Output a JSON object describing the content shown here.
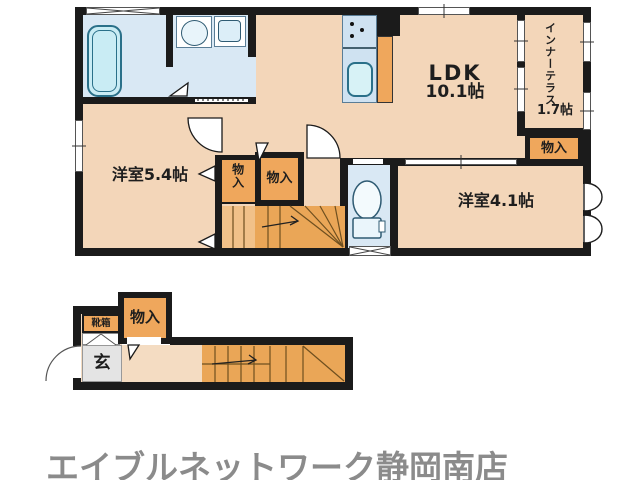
{
  "floor_plan": {
    "labels": {
      "ldk_name": "LDK",
      "ldk_size": "10.1帖",
      "terrace_name": "インナーテラス",
      "terrace_size": "1.7帖",
      "western_room_large": "洋室5.4帖",
      "western_room_small": "洋室4.1帖",
      "storage": "物入",
      "entrance": "玄",
      "shoe_box": "靴箱"
    },
    "fixtures": {
      "bathtub": "bathtub",
      "vanity_sink": "vanity-sink",
      "washer_pan": "washing-machine-pan",
      "stove": "stove-burners",
      "kitchen_sink": "kitchen-sink",
      "toilet": "toilet",
      "stairs_upper": "staircase-2f",
      "stairs_lower": "staircase-1f"
    },
    "colors": {
      "wall": "#1b1b1b",
      "room_floor": "#f3d6b9",
      "wet_area_floor": "#d9e8f4",
      "bathtub_fill": "#c9ecf4",
      "storage_fill": "#efa75c",
      "stairs_fill": "#eaa657",
      "entrance_floor": "#e4e4e4",
      "hallway_floor": "#f4dcc2"
    }
  },
  "footer": {
    "store_name": "エイブルネットワーク静岡南店",
    "text_color": "#8b8b8b"
  }
}
